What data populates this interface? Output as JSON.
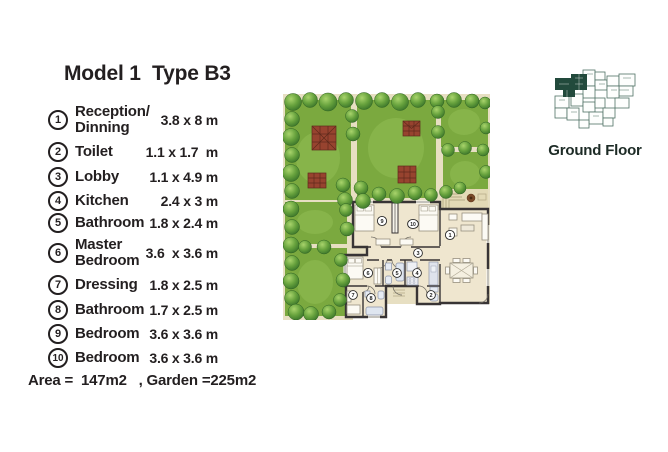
{
  "title": "Model 1  Type B3",
  "legend": [
    {
      "num": "1",
      "line1": "Reception/",
      "line2": "Dinning",
      "dims": "3.8 x 8 m"
    },
    {
      "num": "2",
      "line1": "Toilet",
      "line2": "",
      "dims": "1.1 x 1.7  m"
    },
    {
      "num": "3",
      "line1": "Lobby",
      "line2": "",
      "dims": "1.1 x 4.9 m"
    },
    {
      "num": "4",
      "line1": "Kitchen",
      "line2": "",
      "dims": "2.4 x 3 m"
    },
    {
      "num": "5",
      "line1": "Bathroom",
      "line2": "",
      "dims": "1.8 x 2.4 m"
    },
    {
      "num": "6",
      "line1": "Master",
      "line2": "Bedroom",
      "dims": "3.6  x 3.6 m"
    },
    {
      "num": "7",
      "line1": "Dressing",
      "line2": "",
      "dims": "1.8 x 2.5 m"
    },
    {
      "num": "8",
      "line1": "Bathroom",
      "line2": "",
      "dims": "1.7 x 2.5 m"
    },
    {
      "num": "9",
      "line1": "Bedroom",
      "line2": "",
      "dims": "3.6 x 3.6 m"
    },
    {
      "num": "10",
      "line1": "Bedroom",
      "line2": "",
      "dims": "3.6 x 3.6 m"
    }
  ],
  "footer": "Area =  147m2   , Garden =225m2",
  "ground_floor_label": "Ground Floor",
  "plan_rooms": {
    "reception": "1",
    "toilet": "2",
    "lobby": "3",
    "kitchen": "4",
    "bathroom5": "5",
    "master": "6",
    "dressing": "7",
    "bathroom8": "8",
    "bedroom9": "9",
    "bedroom10": "10"
  },
  "colors": {
    "text": "#231f20",
    "lawn": "#7ba93f",
    "tree": "#4f8f33",
    "path": "#e7dfc2",
    "pergola": "#97432f",
    "floor": "#efe6cf",
    "wall": "#383435",
    "ground_floor_icon": "#2a4f42"
  }
}
